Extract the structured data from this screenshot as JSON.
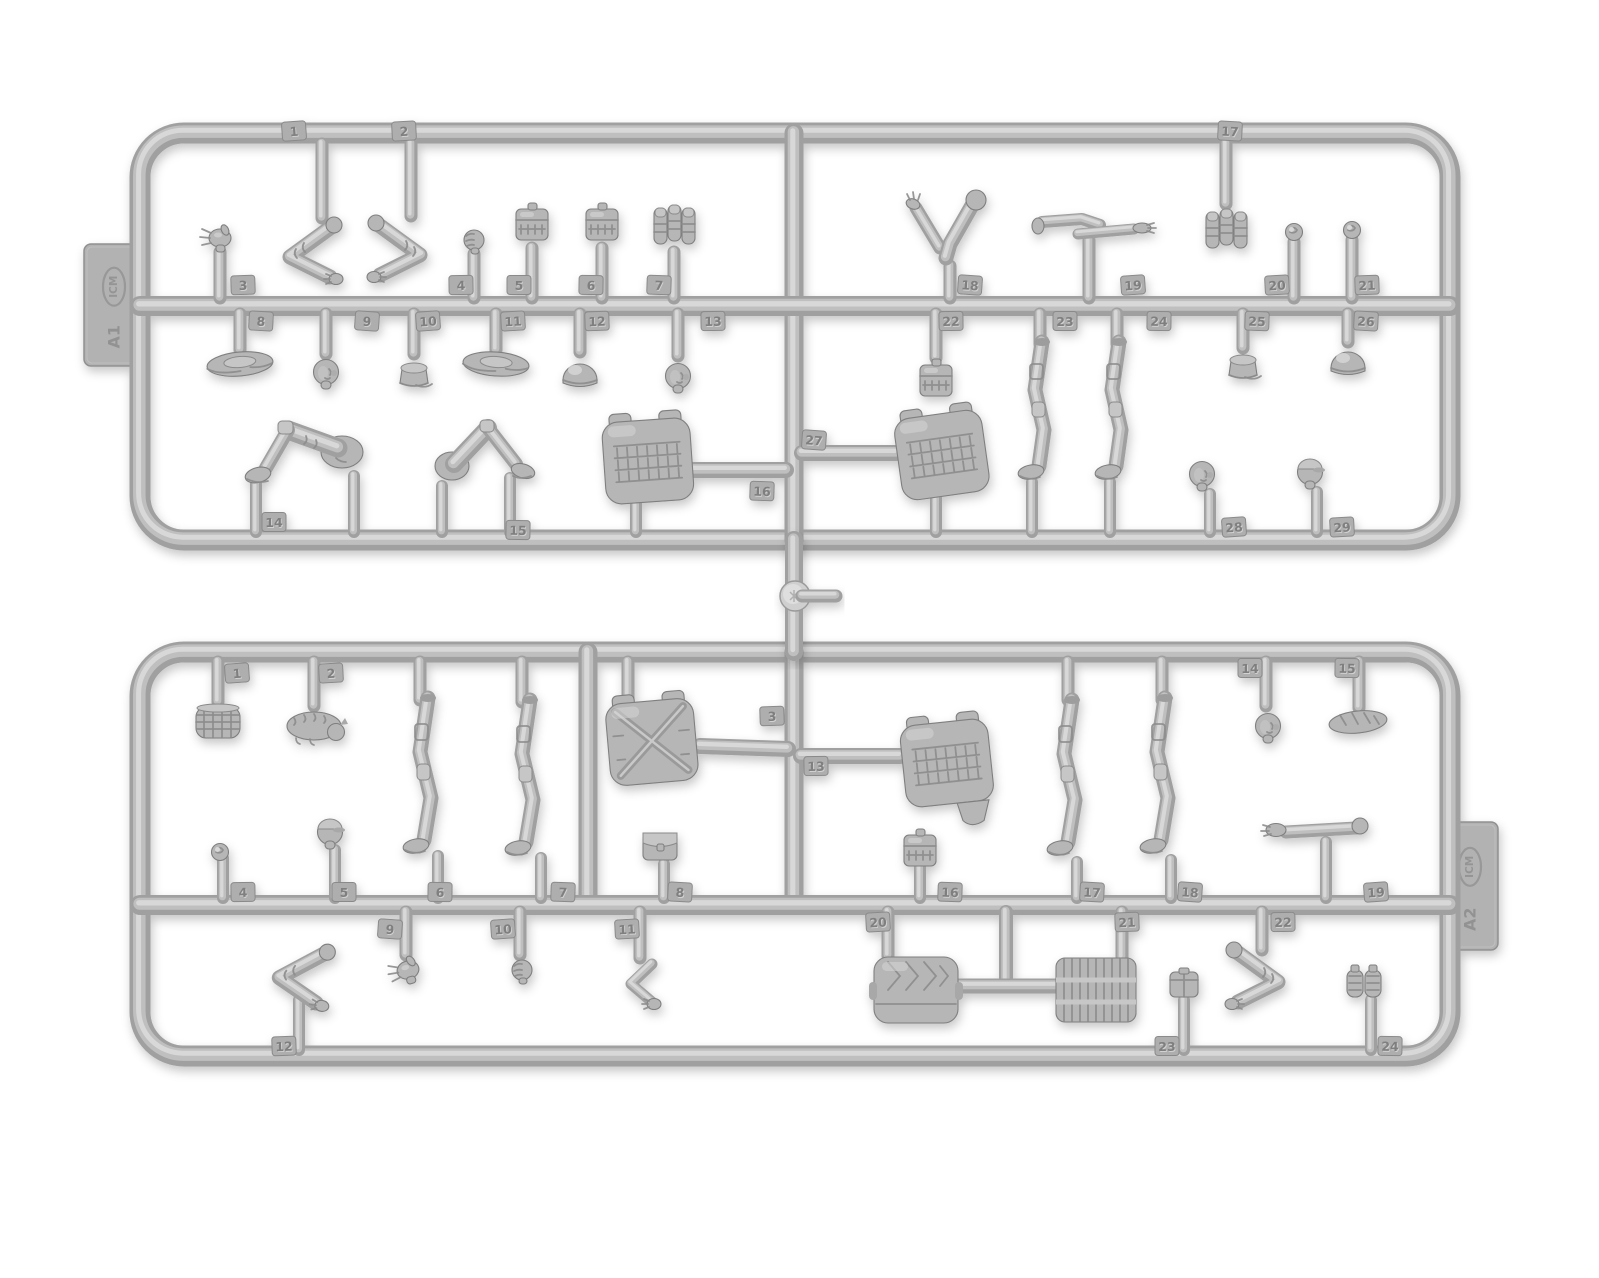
{
  "image": {
    "width": 1599,
    "height": 1278,
    "background": "#ffffff"
  },
  "brand": "ICM",
  "palette": {
    "plastic_base": "#b6b6b6",
    "plastic_mid": "#bfbfbf",
    "plastic_light": "#d8d8d8",
    "plastic_dark": "#a0a0a0",
    "plastic_edge": "#7f7f7f",
    "tag_fill": "#aeaeae",
    "tag_edge": "#8a8a8a",
    "number_dark": "#7f7f7f",
    "number_light": "#d2d2d2",
    "shadow_opacity": 0.22
  },
  "junction": {
    "x": 794,
    "y1": 540,
    "y2": 652,
    "disc_y": 596,
    "disc_r": 15,
    "stub_x2": 836
  },
  "sprues": [
    {
      "id": "a1",
      "label": "A1",
      "tab": {
        "side": "left",
        "x": 84,
        "y": 244,
        "w": 60,
        "h": 122
      },
      "frame": {
        "left": 140,
        "top": 133,
        "right": 1450,
        "bottom": 540,
        "radius": 44
      },
      "rails": [
        306
      ],
      "verticals": [
        [
          794,
          133,
          540
        ]
      ],
      "parts": [
        {
          "n": "1",
          "name": "bent-arm",
          "type": "arm-bent",
          "x": 306,
          "y": 251,
          "stub": [
            322,
            144,
            218
          ],
          "tag": [
            294,
            131
          ]
        },
        {
          "n": "2",
          "name": "bent-arm",
          "type": "arm-bent",
          "mirror": 1,
          "x": 404,
          "y": 249,
          "stub": [
            411,
            144,
            216
          ],
          "tag": [
            404,
            131
          ]
        },
        {
          "n": "3",
          "name": "open-hand",
          "type": "open-hand",
          "x": 220,
          "y": 238,
          "stub": [
            220,
            298,
            252
          ],
          "tag": [
            243,
            285
          ]
        },
        {
          "n": "4",
          "name": "fist",
          "type": "fist",
          "x": 474,
          "y": 240,
          "stub": [
            474,
            298,
            254
          ],
          "tag": [
            461,
            285
          ]
        },
        {
          "n": "5",
          "name": "grid-pouch",
          "type": "grid-pouch",
          "x": 532,
          "y": 224,
          "stub": [
            532,
            298,
            248
          ],
          "tag": [
            519,
            285
          ]
        },
        {
          "n": "6",
          "name": "grid-pouch",
          "type": "grid-pouch",
          "x": 602,
          "y": 224,
          "stub": [
            602,
            298,
            248
          ],
          "tag": [
            591,
            285
          ]
        },
        {
          "n": "7",
          "name": "magazine-pouch",
          "type": "mag-pouch",
          "x": 674,
          "y": 226,
          "stub": [
            674,
            298,
            252
          ],
          "tag": [
            659,
            285
          ]
        },
        {
          "n": "8",
          "name": "boonie-hat",
          "type": "boonie-hat",
          "rot": -5,
          "x": 240,
          "y": 364,
          "stub": [
            240,
            314,
            350
          ],
          "tag": [
            261,
            321
          ]
        },
        {
          "n": "9",
          "name": "bare-head",
          "type": "bare-head",
          "x": 326,
          "y": 372,
          "stub": [
            326,
            314,
            354
          ],
          "tag": [
            367,
            321
          ]
        },
        {
          "n": "10",
          "name": "patrol-cap",
          "type": "patrol-cap",
          "x": 414,
          "y": 374,
          "stub": [
            414,
            314,
            354
          ],
          "tag": [
            428,
            321
          ]
        },
        {
          "n": "11",
          "name": "boonie-hat",
          "type": "boonie-hat",
          "rot": 4,
          "x": 496,
          "y": 364,
          "stub": [
            496,
            314,
            350
          ],
          "tag": [
            513,
            321
          ]
        },
        {
          "n": "12",
          "name": "helmet",
          "type": "helmet",
          "x": 580,
          "y": 374,
          "stub": [
            580,
            314,
            352
          ],
          "tag": [
            597,
            321
          ]
        },
        {
          "n": "13",
          "name": "bare-head",
          "type": "bare-head",
          "x": 678,
          "y": 376,
          "stub": [
            678,
            314,
            356
          ],
          "tag": [
            713,
            321
          ]
        },
        {
          "n": "14",
          "name": "seated-legs",
          "type": "seated-legs",
          "x": 306,
          "y": 452,
          "posts": [
            [
              256,
              484,
              532
            ],
            [
              354,
              476,
              532
            ]
          ],
          "tag": [
            274,
            522
          ]
        },
        {
          "n": "15",
          "name": "kneeling-legs",
          "type": "kneeling-legs",
          "x": 486,
          "y": 452,
          "posts": [
            [
              442,
              486,
              532
            ],
            [
              510,
              478,
              532
            ]
          ],
          "tag": [
            518,
            530
          ]
        },
        {
          "n": "16",
          "name": "plate-carrier-vest",
          "type": "vest",
          "molle": 1,
          "rot": -4,
          "x": 648,
          "y": 462,
          "runner": [
            690,
            470,
            786,
            470
          ],
          "posts": [
            [
              636,
              502,
              532
            ]
          ],
          "tag": [
            762,
            491
          ]
        },
        {
          "n": "17",
          "name": "magazine-pouch",
          "type": "mag-pouch",
          "x": 1226,
          "y": 230,
          "stub": [
            1226,
            144,
            204
          ],
          "tag": [
            1230,
            131
          ]
        },
        {
          "n": "18",
          "name": "raised-arms",
          "type": "arms-raised",
          "x": 946,
          "y": 234,
          "stub": [
            950,
            298,
            266
          ],
          "tag": [
            970,
            285
          ]
        },
        {
          "n": "19",
          "name": "paired-arms",
          "type": "arms-pair",
          "x": 1092,
          "y": 228,
          "stub": [
            1089,
            298,
            240
          ],
          "tag": [
            1133,
            285
          ]
        },
        {
          "n": "20",
          "name": "rolled-item",
          "type": "rolled-item",
          "x": 1294,
          "y": 232,
          "stub": [
            1294,
            298,
            242
          ],
          "tag": [
            1277,
            285
          ]
        },
        {
          "n": "21",
          "name": "rolled-item",
          "type": "rolled-item",
          "x": 1352,
          "y": 230,
          "stub": [
            1352,
            298,
            240
          ],
          "tag": [
            1367,
            285
          ]
        },
        {
          "n": "22",
          "name": "grid-pouch",
          "type": "grid-pouch",
          "x": 936,
          "y": 380,
          "stub": [
            936,
            314,
            358
          ],
          "tag": [
            951,
            321
          ]
        },
        {
          "n": "23",
          "name": "standing-leg",
          "type": "standing-leg",
          "x": 1040,
          "y": 414,
          "stub": [
            1040,
            314,
            344
          ],
          "posts": [
            [
              1032,
              482,
              532
            ]
          ],
          "tag": [
            1065,
            321
          ]
        },
        {
          "n": "24",
          "name": "standing-leg",
          "type": "standing-leg",
          "x": 1117,
          "y": 414,
          "stub": [
            1117,
            314,
            344
          ],
          "posts": [
            [
              1110,
              482,
              532
            ]
          ],
          "tag": [
            1159,
            321
          ]
        },
        {
          "n": "25",
          "name": "patrol-cap",
          "type": "patrol-cap",
          "x": 1243,
          "y": 366,
          "stub": [
            1243,
            314,
            348
          ],
          "tag": [
            1257,
            321
          ]
        },
        {
          "n": "26",
          "name": "helmet",
          "type": "helmet",
          "x": 1348,
          "y": 362,
          "stub": [
            1348,
            314,
            342
          ],
          "tag": [
            1366,
            321
          ]
        },
        {
          "n": "27",
          "name": "plate-carrier-vest",
          "type": "vest",
          "molle": 1,
          "rot": -8,
          "x": 942,
          "y": 456,
          "runner": [
            802,
            453,
            896,
            453
          ],
          "posts": [
            [
              936,
              498,
              532
            ]
          ],
          "tag": [
            814,
            440
          ]
        },
        {
          "n": "28",
          "name": "bare-head",
          "type": "bare-head",
          "x": 1202,
          "y": 474,
          "posts": [
            [
              1210,
              494,
              532
            ]
          ],
          "tag": [
            1234,
            527
          ]
        },
        {
          "n": "29",
          "name": "capped-head",
          "type": "capped-head",
          "x": 1310,
          "y": 472,
          "posts": [
            [
              1317,
              492,
              532
            ]
          ],
          "tag": [
            1342,
            527
          ]
        }
      ]
    },
    {
      "id": "a2",
      "label": "A2",
      "tab": {
        "side": "right",
        "x": 1442,
        "y": 822,
        "w": 56,
        "h": 128
      },
      "frame": {
        "left": 140,
        "top": 652,
        "right": 1450,
        "bottom": 1056,
        "radius": 44
      },
      "rails": [
        905
      ],
      "verticals": [
        [
          588,
          652,
          905
        ],
        [
          794,
          652,
          905
        ]
      ],
      "parts": [
        {
          "n": "1",
          "name": "basket",
          "type": "basket",
          "x": 218,
          "y": 722,
          "stub": [
            218,
            662,
            702
          ],
          "tag": [
            237,
            673
          ]
        },
        {
          "n": "2",
          "name": "animal-figure",
          "type": "animal",
          "x": 314,
          "y": 726,
          "stub": [
            314,
            662,
            706
          ],
          "tag": [
            331,
            673
          ]
        },
        {
          "n": "3",
          "name": "plate-carrier-vest",
          "type": "vest",
          "xstrap": 1,
          "rot": -5,
          "x": 652,
          "y": 743,
          "stub": [
            628,
            662,
            700
          ],
          "runner": [
            700,
            746,
            788,
            749
          ],
          "tag": [
            772,
            716
          ]
        },
        {
          "n": "4",
          "name": "rolled-item",
          "type": "rolled-item",
          "x": 220,
          "y": 852,
          "posts": [
            [
              223,
              858,
              898
            ]
          ],
          "tag": [
            243,
            892
          ]
        },
        {
          "n": "5",
          "name": "capped-head",
          "type": "capped-head",
          "x": 330,
          "y": 832,
          "posts": [
            [
              335,
              850,
              898
            ]
          ],
          "tag": [
            344,
            892
          ]
        },
        {
          "n": "6",
          "name": "standing-leg",
          "type": "standing-leg-long",
          "x": 426,
          "y": 780,
          "stub": [
            420,
            662,
            700
          ],
          "posts": [
            [
              438,
              856,
              898
            ]
          ],
          "tag": [
            440,
            892
          ]
        },
        {
          "n": "7",
          "name": "standing-leg",
          "type": "standing-leg-long",
          "x": 528,
          "y": 782,
          "stub": [
            522,
            662,
            702
          ],
          "posts": [
            [
              541,
              858,
              898
            ]
          ],
          "tag": [
            563,
            892
          ]
        },
        {
          "n": "8",
          "name": "flap-pouch",
          "type": "flap-pouch",
          "x": 660,
          "y": 846,
          "posts": [
            [
              664,
              864,
              898
            ]
          ],
          "tag": [
            680,
            892
          ]
        },
        {
          "n": "9",
          "name": "open-hand",
          "type": "open-hand",
          "rot": -15,
          "x": 408,
          "y": 970,
          "stub": [
            406,
            912,
            955
          ],
          "tag": [
            390,
            929
          ]
        },
        {
          "n": "10",
          "name": "fist",
          "type": "fist",
          "x": 522,
          "y": 970,
          "stub": [
            520,
            912,
            955
          ],
          "tag": [
            503,
            929
          ]
        },
        {
          "n": "11",
          "name": "bent-arm",
          "type": "arm-bent-sm",
          "x": 640,
          "y": 982,
          "stub": [
            640,
            912,
            958
          ],
          "tag": [
            627,
            929
          ]
        },
        {
          "n": "12",
          "name": "bent-arm",
          "type": "arm-bent",
          "rot": 8,
          "x": 296,
          "y": 974,
          "posts": [
            [
              299,
              1000,
              1050
            ]
          ],
          "tag": [
            284,
            1046
          ]
        },
        {
          "n": "13",
          "name": "plate-carrier-vest",
          "type": "vest",
          "molle": 1,
          "flap": 1,
          "rot": -6,
          "x": 947,
          "y": 764,
          "runner": [
            801,
            756,
            900,
            756
          ],
          "tag": [
            816,
            766
          ]
        },
        {
          "n": "14",
          "name": "bare-head",
          "type": "bare-head",
          "x": 1268,
          "y": 726,
          "stub": [
            1266,
            662,
            706
          ],
          "tag": [
            1250,
            668
          ]
        },
        {
          "n": "15",
          "name": "bread-loaf",
          "type": "bread-loaf",
          "x": 1358,
          "y": 722,
          "stub": [
            1359,
            662,
            708
          ],
          "tag": [
            1347,
            668
          ]
        },
        {
          "n": "16",
          "name": "grid-pouch",
          "type": "grid-pouch",
          "x": 920,
          "y": 850,
          "posts": [
            [
              920,
              866,
              898
            ]
          ],
          "tag": [
            950,
            892
          ]
        },
        {
          "n": "17",
          "name": "standing-leg",
          "type": "standing-leg-long",
          "x": 1070,
          "y": 782,
          "stub": [
            1068,
            662,
            700
          ],
          "posts": [
            [
              1077,
              862,
              898
            ]
          ],
          "tag": [
            1092,
            892
          ]
        },
        {
          "n": "18",
          "name": "standing-leg",
          "type": "standing-leg-long",
          "x": 1163,
          "y": 780,
          "stub": [
            1162,
            662,
            700
          ],
          "posts": [
            [
              1171,
              860,
              898
            ]
          ],
          "tag": [
            1190,
            892
          ]
        },
        {
          "n": "19",
          "name": "extended-arm",
          "type": "arm-extended",
          "x": 1316,
          "y": 830,
          "posts": [
            [
              1326,
              842,
              898
            ]
          ],
          "tag": [
            1376,
            892
          ]
        },
        {
          "n": "20",
          "name": "duffel-bag",
          "type": "duffel",
          "x": 916,
          "y": 990,
          "stub": [
            888,
            912,
            956
          ],
          "runnerT": {
            "v": [
              1006,
              912,
              986
            ],
            "h": [
              956,
              1056,
              986
            ]
          },
          "tag": [
            878,
            922
          ]
        },
        {
          "n": "21",
          "name": "wicker-crate",
          "type": "crate",
          "x": 1096,
          "y": 990,
          "stub": [
            1122,
            912,
            958
          ],
          "tag": [
            1127,
            922
          ]
        },
        {
          "n": "22",
          "name": "bent-arm",
          "type": "arm-bent",
          "mirror": 1,
          "x": 1262,
          "y": 976,
          "stub": [
            1262,
            912,
            950
          ],
          "tag": [
            1283,
            922
          ]
        },
        {
          "n": "23",
          "name": "small-pouch",
          "type": "small-pouch",
          "x": 1184,
          "y": 984,
          "posts": [
            [
              1184,
              1000,
              1050
            ]
          ],
          "tag": [
            1167,
            1046
          ]
        },
        {
          "n": "24",
          "name": "grenade-pair",
          "type": "grenade-pair",
          "x": 1364,
          "y": 984,
          "posts": [
            [
              1371,
              1000,
              1050
            ]
          ],
          "tag": [
            1390,
            1046
          ]
        }
      ]
    }
  ]
}
